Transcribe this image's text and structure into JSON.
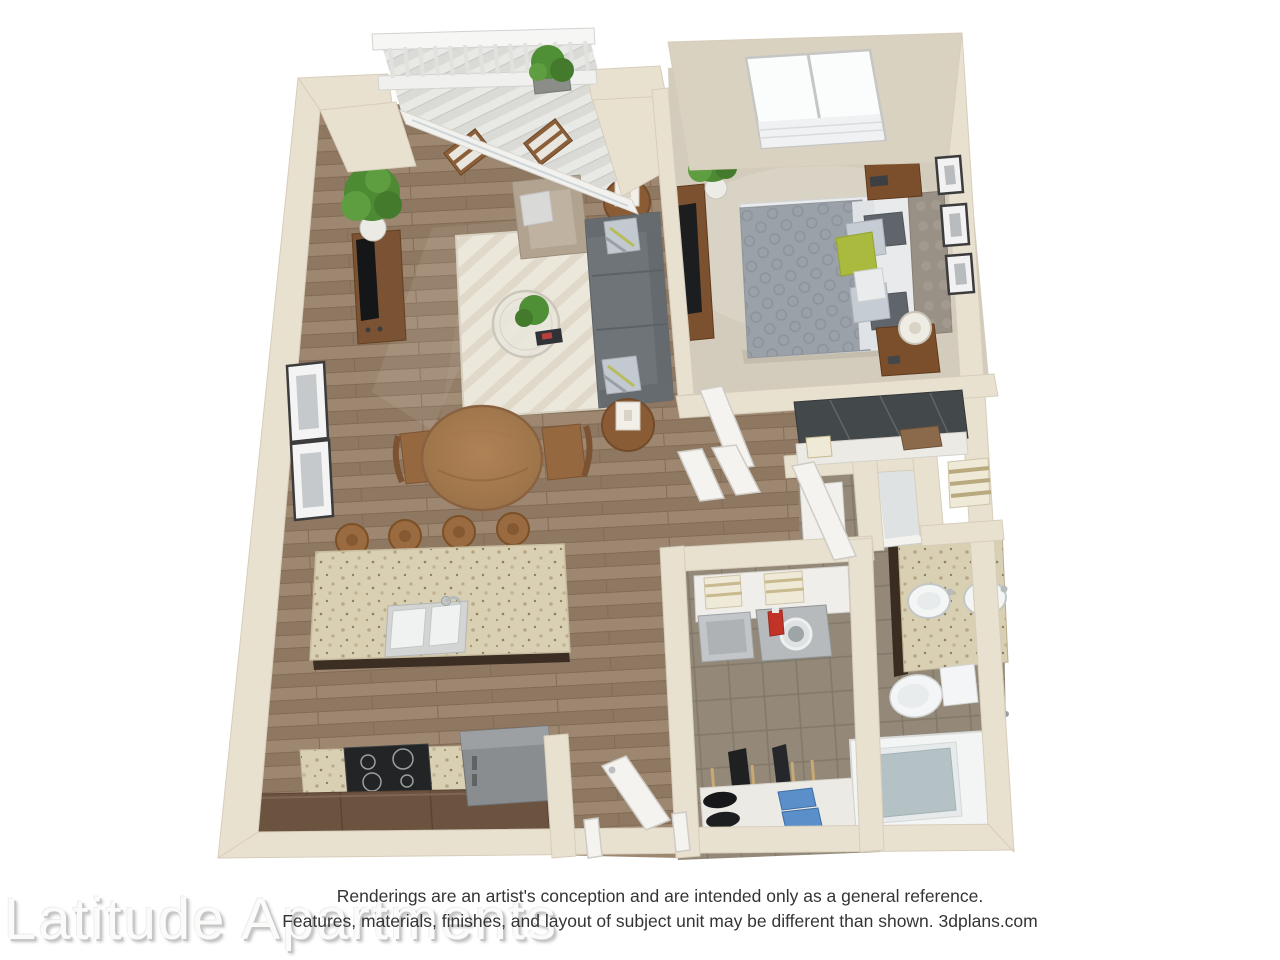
{
  "meta": {
    "alt": "3D floor plan rendering of a one-bedroom, one-bathroom apartment viewed from above"
  },
  "watermark": {
    "text": "Latitude Apartments"
  },
  "disclaimer": {
    "line1": "Renderings are an artist's conception and are intended only as a general reference.",
    "line2": "Features, materials, finishes, and layout of subject unit may be different than shown. 3dplans.com"
  },
  "rooms": {
    "living_room": "living room",
    "dining_area": "dining area",
    "kitchen": "kitchen",
    "balcony": "balcony",
    "bedroom": "bedroom",
    "closet": "bedroom closet",
    "bathroom": "bathroom",
    "laundry_closet": "laundry and storage closet",
    "entry": "entry door"
  },
  "palette": {
    "background": "#ffffff",
    "wall": "#e9e1d0",
    "wall_inner_face": "#dad2c1",
    "wall_stroke": "#d6cdba",
    "wood_floor": "#97806a",
    "carpet": "#d3ccbc",
    "tile": "#948978",
    "balcony_deck": "#dadbd7",
    "rug": "#ece7db",
    "sofa_gray": "#6f7478",
    "armchair_beige": "#b1a390",
    "wood_furniture": "#7b5233",
    "granite": "#d9cfb3",
    "cabinet_dark": "#6b5340",
    "accent_green_pillow": "#a9ba3e",
    "plant_green": "#4e8a33",
    "tub_water": "#b4c2c6",
    "appliance_gray": "#898d90",
    "detergent_red": "#c23327",
    "shoe_blue": "#5b8fc9"
  }
}
